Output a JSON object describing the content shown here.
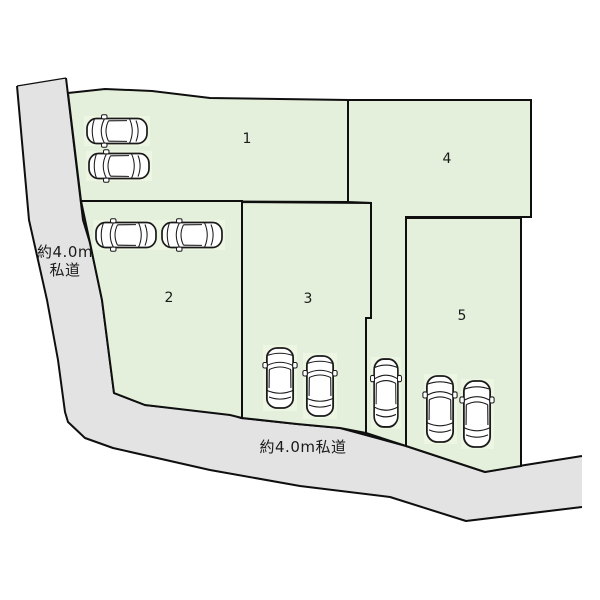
{
  "plan": {
    "parcels": [
      {
        "number": "1",
        "cars": 2
      },
      {
        "number": "2",
        "cars": 2
      },
      {
        "number": "3",
        "cars": 2
      },
      {
        "number": "4",
        "cars": 1
      },
      {
        "number": "5",
        "cars": 2
      }
    ],
    "left_road": {
      "label_line1": "約4.0m",
      "label_line2": "私道"
    },
    "bottom_road": {
      "label": "約4.0m私道"
    },
    "cars_total": 9,
    "colors": {
      "parcel_fill": "#e4f0dc",
      "car_highlight": "#edf6e2",
      "road_fill": "#e3e3e3",
      "outline": "#0f0f0f",
      "background": "#ffffff"
    }
  }
}
